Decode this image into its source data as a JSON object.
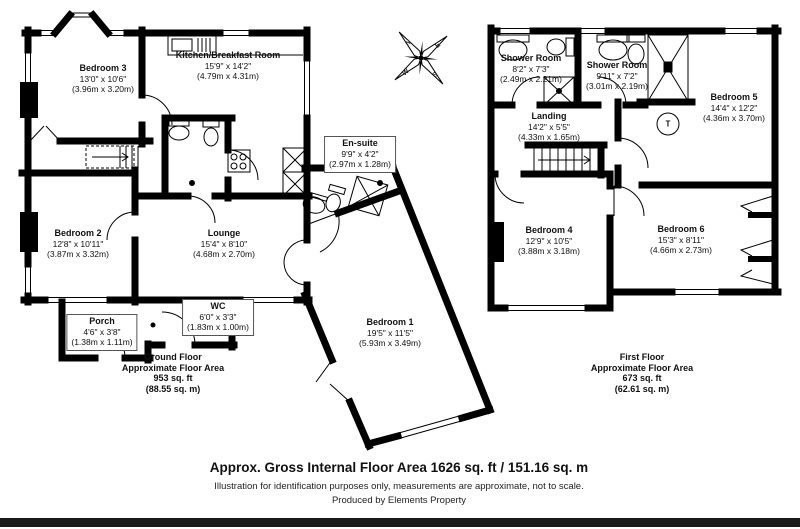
{
  "compass": {
    "n": "N",
    "e": "E",
    "s": "S",
    "w": "W"
  },
  "ground_floor": {
    "rooms": {
      "bedroom3": {
        "name": "Bedroom 3",
        "imperial": "13'0\" x 10'6\"",
        "metric": "(3.96m x 3.20m)"
      },
      "kitchen": {
        "name": "Kitchen/Breakfast Room",
        "imperial": "15'9\" x 14'2\"",
        "metric": "(4.79m x 4.31m)"
      },
      "ensuite": {
        "name": "En-suite",
        "imperial": "9'9\" x 4'2\"",
        "metric": "(2.97m x 1.28m)"
      },
      "bedroom2": {
        "name": "Bedroom 2",
        "imperial": "12'8\" x 10'11\"",
        "metric": "(3.87m x 3.32m)"
      },
      "lounge": {
        "name": "Lounge",
        "imperial": "15'4\" x 8'10\"",
        "metric": "(4.68m x 2.70m)"
      },
      "wc": {
        "name": "WC",
        "imperial": "6'0\" x 3'3\"",
        "metric": "(1.83m x 1.00m)"
      },
      "porch": {
        "name": "Porch",
        "imperial": "4'6\" x 3'8\"",
        "metric": "(1.38m x 1.11m)"
      },
      "bedroom1": {
        "name": "Bedroom 1",
        "imperial": "19'5\" x 11'5\"",
        "metric": "(5.93m x 3.49m)"
      }
    },
    "summary": {
      "line1": "Ground Floor",
      "line2": "Approximate Floor Area",
      "line3": "953 sq. ft",
      "line4": "(88.55 sq. m)"
    }
  },
  "first_floor": {
    "rooms": {
      "shower1": {
        "name": "Shower Room",
        "imperial": "8'2\" x 7'3\"",
        "metric": "(2.49m x 2.21m)"
      },
      "shower2": {
        "name": "Shower Room",
        "imperial": "9'11\" x 7'2\"",
        "metric": "(3.01m x 2.19m)"
      },
      "landing": {
        "name": "Landing",
        "imperial": "14'2\" x 5'5\"",
        "metric": "(4.33m x 1.65m)"
      },
      "bedroom5": {
        "name": "Bedroom 5",
        "imperial": "14'4\" x 12'2\"",
        "metric": "(4.36m x 3.70m)"
      },
      "bedroom4": {
        "name": "Bedroom 4",
        "imperial": "12'9\" x 10'5\"",
        "metric": "(3.88m x 3.18m)"
      },
      "bedroom6": {
        "name": "Bedroom 6",
        "imperial": "15'3\" x 8'11\"",
        "metric": "(4.66m x 2.73m)"
      }
    },
    "tank_label": "T",
    "summary": {
      "line1": "First Floor",
      "line2": "Approximate Floor Area",
      "line3": "673 sq. ft",
      "line4": "(62.61 sq. m)"
    }
  },
  "footer": {
    "title": "Approx. Gross Internal Floor Area 1626 sq. ft / 151.16 sq. m",
    "disclaimer": "Illustration for identification purposes only, measurements are approximate, not to scale.",
    "credit": "Produced by Elements Property"
  },
  "colors": {
    "wall": "#000000",
    "bar": "#1a1a1a",
    "background": "#ffffff"
  }
}
